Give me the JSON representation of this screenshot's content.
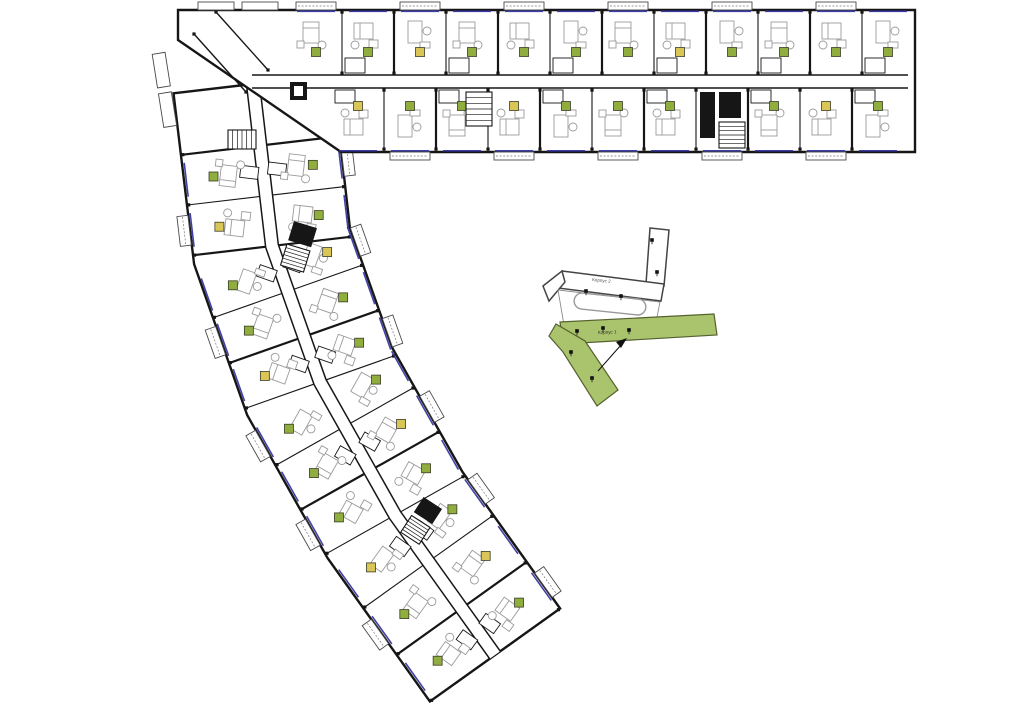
{
  "site_plan": {
    "korpus1_label": "Корпус 1",
    "korpus2_label": "Корпус 2"
  },
  "colors": {
    "wall": "#161616",
    "window_blue": "#31319e",
    "furniture_gray": "#9b9b9b",
    "badge_green": "#8fae3e",
    "badge_yellow": "#d9c657",
    "site_green_fill": "#a9c46c",
    "site_green_edge": "#55612f",
    "site_outline": "#444444",
    "paper": "#ffffff"
  },
  "top_wing": {
    "units_top": 12,
    "units_bottom": 11,
    "badge_colors_top": [
      "green",
      "green",
      "yellow",
      "green",
      "green",
      "green",
      "green",
      "yellow",
      "green",
      "green",
      "green",
      "green"
    ],
    "badge_colors_bottom": [
      "yellow",
      "green",
      "green",
      "yellow",
      "green",
      "green",
      "green",
      "green",
      "green",
      "yellow",
      "green"
    ],
    "core_unit_indexes_bottom": [
      7
    ]
  },
  "diagonal_wing": {
    "units_per_segment": [
      2,
      3,
      3,
      3
    ],
    "badge_colors_right": [
      "green",
      "green",
      "yellow",
      "green",
      "green",
      "green",
      "yellow",
      "green",
      "green",
      "yellow",
      "green"
    ],
    "badge_colors_left": [
      "green",
      "yellow",
      "green",
      "green",
      "yellow",
      "green",
      "green",
      "green",
      "yellow",
      "green",
      "green"
    ]
  }
}
